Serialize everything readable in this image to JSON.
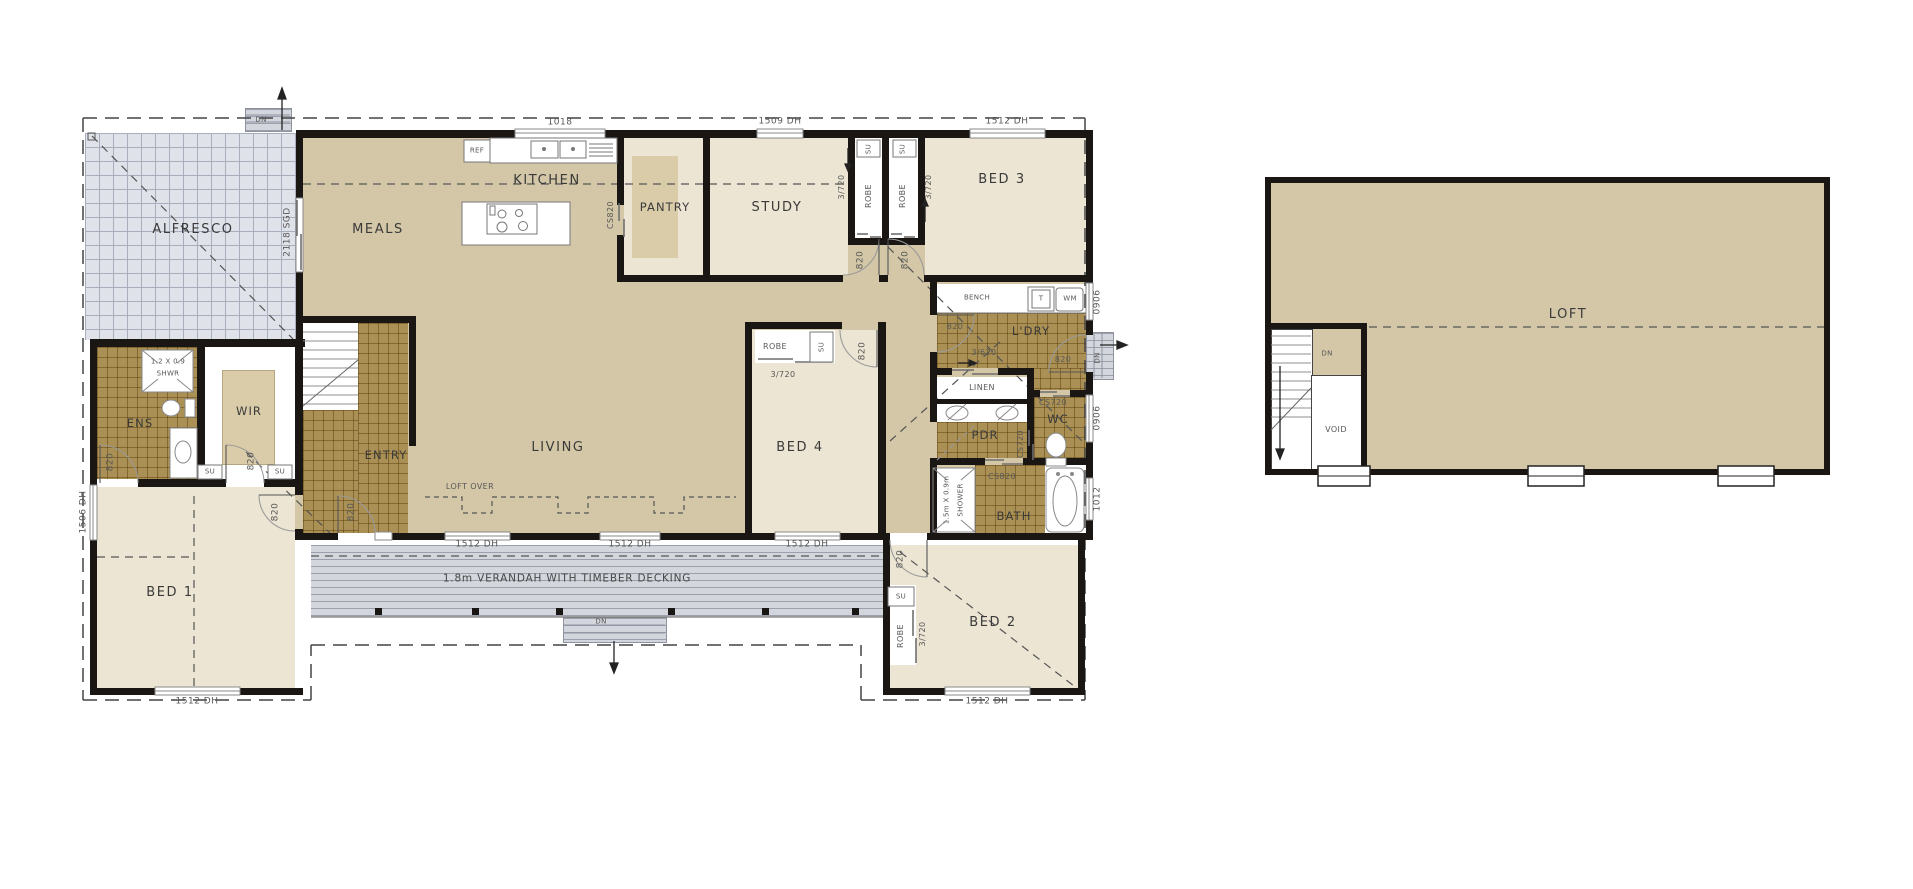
{
  "colors": {
    "wall": "#1a1613",
    "interior_tan": "#d4c7a7",
    "room_cream": "#ece5d3",
    "wet_tile_brown": "#aa9054",
    "alfresco_grey": "#e0e2e9",
    "deck_grey": "#d3d6dd",
    "dash_line": "#4a4a4a"
  },
  "rooms": {
    "alfresco": "ALFRESCO",
    "meals": "MEALS",
    "kitchen": "KITCHEN",
    "pantry": "PANTRY",
    "study": "STUDY",
    "bed3": "BED 3",
    "ldry": "L'DRY",
    "linen": "LINEN",
    "pdr": "PDR",
    "wc": "WC",
    "bath": "BATH",
    "bed4": "BED 4",
    "living": "LIVING",
    "entry": "ENTRY",
    "ens": "ENS",
    "wir": "WIR",
    "bed1": "BED 1",
    "bed2": "BED 2",
    "loft": "LOFT",
    "void": "VOID"
  },
  "fixtures": {
    "ref": "REF",
    "bench": "BENCH",
    "trough": "T",
    "washing_machine": "WM",
    "robe": "ROBE",
    "su": "SU",
    "dn": "DN",
    "ens_shower_size": "1.2 X 0.9",
    "ens_shower": "SHWR",
    "bath_shower_size": "1.5m X 0.9m",
    "bath_shower": "SHOWER"
  },
  "openings": {
    "sgd": "2118 SGD",
    "door820": "820",
    "cs820": "CS820",
    "cs720": "CS720",
    "robe_slider": "3/720",
    "linen_slider": "3/620",
    "w1018": "1018",
    "w1509": "1509 DH",
    "w1512": "1512 DH",
    "w1506": "1506 DH",
    "w0906": "0906",
    "w1012": "1012"
  },
  "notes": {
    "loft_over": "LOFT OVER",
    "verandah": "1.8m VERANDAH WITH TIMEBER DECKING"
  }
}
